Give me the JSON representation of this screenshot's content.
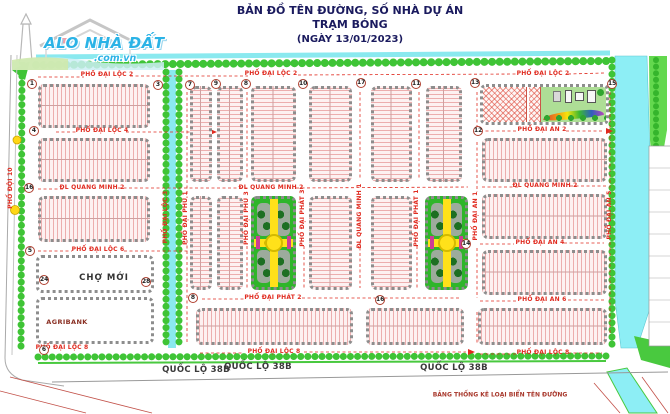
{
  "title": {
    "line1": "BẢN ĐỒ TÊN ĐƯỜNG, SỐ NHÀ DỰ ÁN TRẠM BÓNG",
    "line2": "(NGÀY 13/01/2023)"
  },
  "logo": {
    "name": "ALO NHÀ ĐẤT",
    "domain": ".com.vn"
  },
  "streets": {
    "dai_loc_2": "PHỐ ĐẠI LỘC 2",
    "dai_loc_3": "PHỐ ĐẠI LỘC 3",
    "dai_loc_4": "PHỐ ĐẠI LỘC 4",
    "dai_loc_6": "PHỐ ĐẠI LỘC 6",
    "dai_loc_8": "PHỐ ĐẠI LỘC 8",
    "dai_an_1": "PHỐ ĐẠI AN 1",
    "dai_an_2": "PHỐ ĐẠI AN 2",
    "dai_an_4": "PHỐ ĐẠI AN 4",
    "dai_an_5": "PHỐ ĐẠI AN 5",
    "dai_an_6": "PHỐ ĐẠI AN 6",
    "dai_phu_1": "PHỐ ĐẠI PHÚ 1",
    "dai_phu_3": "PHỐ ĐẠI PHÚ 3",
    "dai_phat_1": "PHỐ ĐẠI PHÁT 1",
    "dai_phat_2": "PHỐ ĐẠI PHÁT 2",
    "dai_phat_3": "PHỐ ĐẠI PHÁT 3",
    "quang_minh_1": "ĐL QUANG MINH 1",
    "quang_minh_2": "ĐL QUANG MINH 2",
    "doi_10": "PHỐ ĐỘI 10",
    "highway": "QUỐC LỘ 38B"
  },
  "landmarks": {
    "market": "CHỢ MỚI",
    "bank": "AGRIBANK"
  },
  "legend": {
    "note": "BẢNG THỐNG KÊ LOẠI BIỂN TÊN ĐƯỜNG"
  },
  "markers": [
    "1",
    "3",
    "7",
    "9",
    "8",
    "10",
    "17",
    "11",
    "13",
    "15",
    "4",
    "12",
    "16",
    "5",
    "14",
    "24",
    "28",
    "8",
    "16",
    "6"
  ],
  "colors": {
    "street_label": "#e02b20",
    "park_green": "#2fb52a",
    "canal_blue": "#8deef5",
    "tree_green": "#3fc436",
    "title_navy": "#1a1a5e",
    "logo_cyan": "#2bb3e6"
  }
}
